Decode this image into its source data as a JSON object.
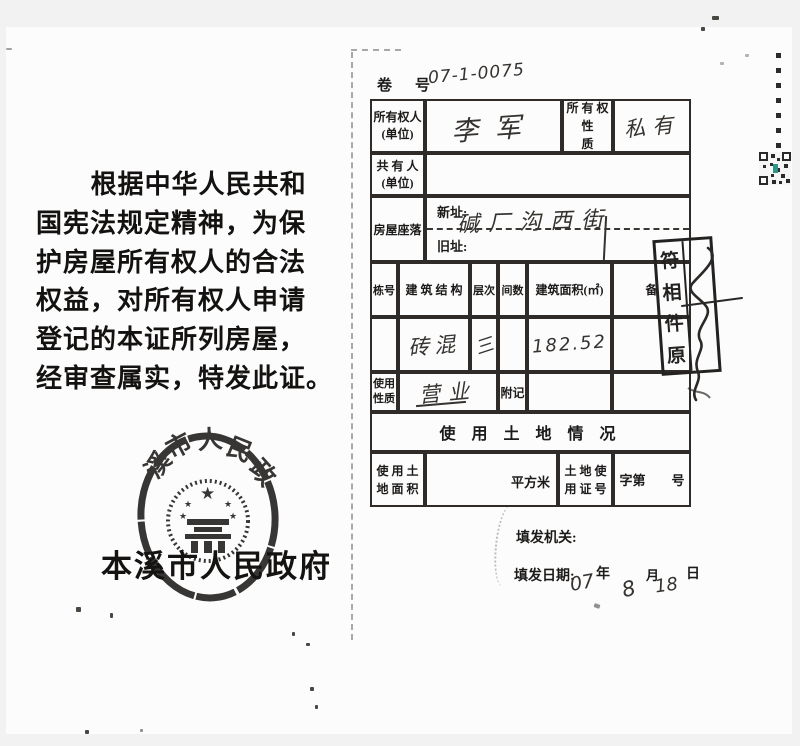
{
  "left": {
    "preamble_lines": [
      "根据中华人民共和",
      "国宪法规定精神，为保",
      "护房屋所有权人的合法",
      "权益，对所有权人申请",
      "登记的本证所列房屋，",
      "经审查属实，特发此证。"
    ],
    "seal": {
      "arc_text": [
        "溪",
        "市",
        "人",
        "民",
        "政"
      ],
      "authority": "本溪市人民政府"
    }
  },
  "form": {
    "volume_label": "卷　号",
    "volume_value": "07-1-0075",
    "owner_label": "所有权人\n(单位)",
    "owner_value": "李军",
    "ownership_nature_label": "所 有 权\n性　　质",
    "ownership_nature_value": "私有",
    "co_owner_label": "共 有 人\n(单位)",
    "location_label": "房屋座落",
    "new_address_label": "新址:",
    "new_address_value": "碱厂沟西街",
    "old_address_label": "旧址:",
    "building_headers": [
      "栋号",
      "建 筑 结 构",
      "层次",
      "间数",
      "建筑面积(㎡)",
      "备"
    ],
    "building_row": {
      "structure": "砖混",
      "floors": "三",
      "area": "182.52"
    },
    "usage_label": "使用\n性质",
    "usage_value": "营业",
    "annotation_label": "附记",
    "land_section_title": "使 用 土 地 情 况",
    "land_area_label": "使 用 土\n地 面 积",
    "land_area_unit": "平方米",
    "land_cert_label": "土 地 使\n用 证 号",
    "land_cert_no": "字第　　号",
    "issuer_label": "填发机关:",
    "issue_date_label": "填发日期:",
    "date_year_value": "07",
    "date_year_unit": "年",
    "date_month_value": "8",
    "date_month_unit": "月",
    "date_day_value": "18",
    "date_day_unit": "日"
  },
  "stamp": {
    "text": "原件相符",
    "chars": [
      "符",
      "相",
      "件",
      "原"
    ]
  }
}
